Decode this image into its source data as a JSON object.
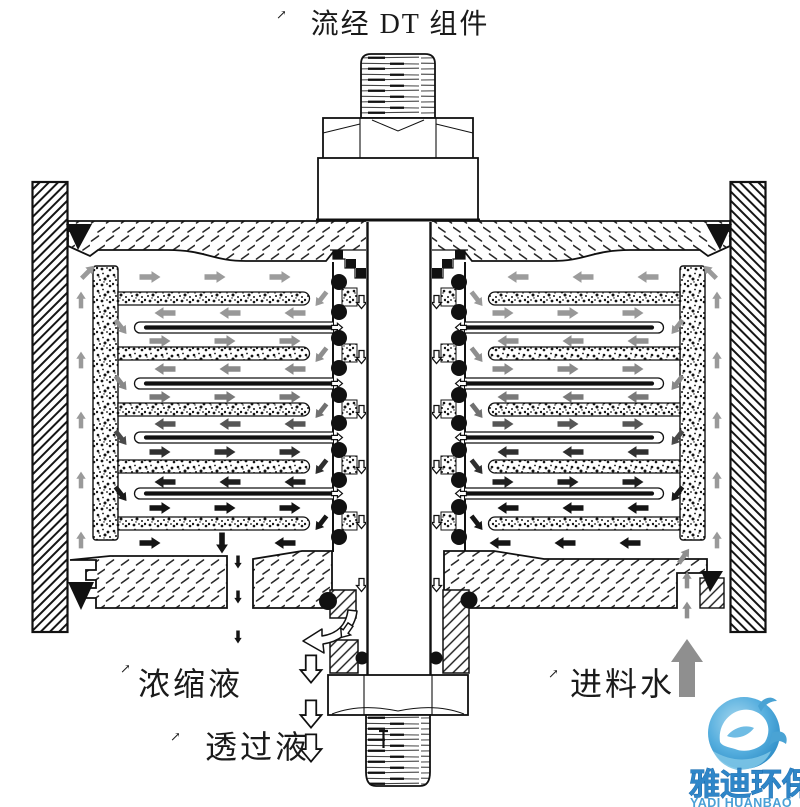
{
  "title": "流经 DT 组件",
  "labels": {
    "concentrate": "浓缩液",
    "permeate": "透过液",
    "feed": "进料水",
    "mark": "↗"
  },
  "logo": {
    "name_cn": "雅迪环保",
    "name_en": "YADI HUANBAO",
    "blue_dark": "#2f86c8",
    "blue_light": "#4aa0d6"
  },
  "colors": {
    "line": "#111111",
    "feed_arrow_gray": "#8f8f8f",
    "light_flow_gray": "#9a9a9a",
    "dark_flow": "#141414",
    "logo_circle_outer": "#2b8cc4",
    "logo_circle_inner": "#a8d8ef"
  },
  "diagram": {
    "counts": {
      "membrane_cushions_per_side": 4,
      "spacer_bars_per_side": 5,
      "o_rings_per_column": 10
    },
    "bar_ys": [
      292,
      347,
      403,
      460,
      517
    ],
    "pocket_ys": [
      322,
      378,
      432,
      488
    ],
    "oring_ys": [
      282,
      312,
      338,
      368,
      395,
      423,
      450,
      480,
      507,
      537
    ],
    "patch_ys": [
      288,
      344,
      400,
      456,
      512
    ],
    "rows": [
      {
        "y": 277,
        "dir": "R",
        "color": "#9c9c9c",
        "xs": [
          150,
          215,
          280
        ]
      },
      {
        "y": 313,
        "dir": "L",
        "color": "#989898",
        "xs": [
          165,
          230,
          295
        ]
      },
      {
        "y": 341,
        "dir": "R",
        "color": "#919191",
        "xs": [
          160,
          225,
          290
        ]
      },
      {
        "y": 369,
        "dir": "L",
        "color": "#8a8a8a",
        "xs": [
          165,
          230,
          295
        ]
      },
      {
        "y": 397,
        "dir": "R",
        "color": "#7a7a7a",
        "xs": [
          160,
          225,
          290
        ]
      },
      {
        "y": 424,
        "dir": "L",
        "color": "#565656",
        "xs": [
          165,
          230,
          295
        ]
      },
      {
        "y": 452,
        "dir": "R",
        "color": "#303030",
        "xs": [
          160,
          225,
          290
        ]
      },
      {
        "y": 482,
        "dir": "L",
        "color": "#1e1e1e",
        "xs": [
          165,
          230,
          295
        ]
      },
      {
        "y": 508,
        "dir": "R",
        "color": "#141414",
        "xs": [
          160,
          225,
          290
        ]
      }
    ],
    "turns_right": [
      {
        "y": 299,
        "color": "#999999"
      },
      {
        "y": 355,
        "color": "#8e8e8e"
      },
      {
        "y": 411,
        "color": "#707070"
      },
      {
        "y": 467,
        "color": "#2e2e2e"
      },
      {
        "y": 523,
        "color": "#161616"
      }
    ],
    "turns_left": [
      {
        "y": 327,
        "color": "#969696"
      },
      {
        "y": 383,
        "color": "#888888"
      },
      {
        "y": 438,
        "color": "#4a4a4a"
      },
      {
        "y": 494,
        "color": "#1a1a1a"
      }
    ],
    "wall_arrow_ys": [
      300,
      360,
      420,
      480,
      540
    ],
    "collector_arrow_ys": [
      302,
      357,
      412,
      467,
      522,
      585
    ],
    "bottom_row": {
      "y": 543,
      "color": "#141414",
      "left": [
        {
          "x": 150,
          "a": 0
        },
        {
          "x": 222,
          "a": 90
        },
        {
          "x": 285,
          "a": 180
        }
      ],
      "right": [
        {
          "x": 500,
          "a": 180
        },
        {
          "x": 565,
          "a": 180
        },
        {
          "x": 630,
          "a": 180
        }
      ]
    },
    "concentrate_arrow_ys": [
      562,
      597,
      637
    ],
    "permeate_arrow_ys": [
      669,
      714,
      748
    ],
    "feed_small_arrow_ys": [
      580,
      610
    ]
  }
}
